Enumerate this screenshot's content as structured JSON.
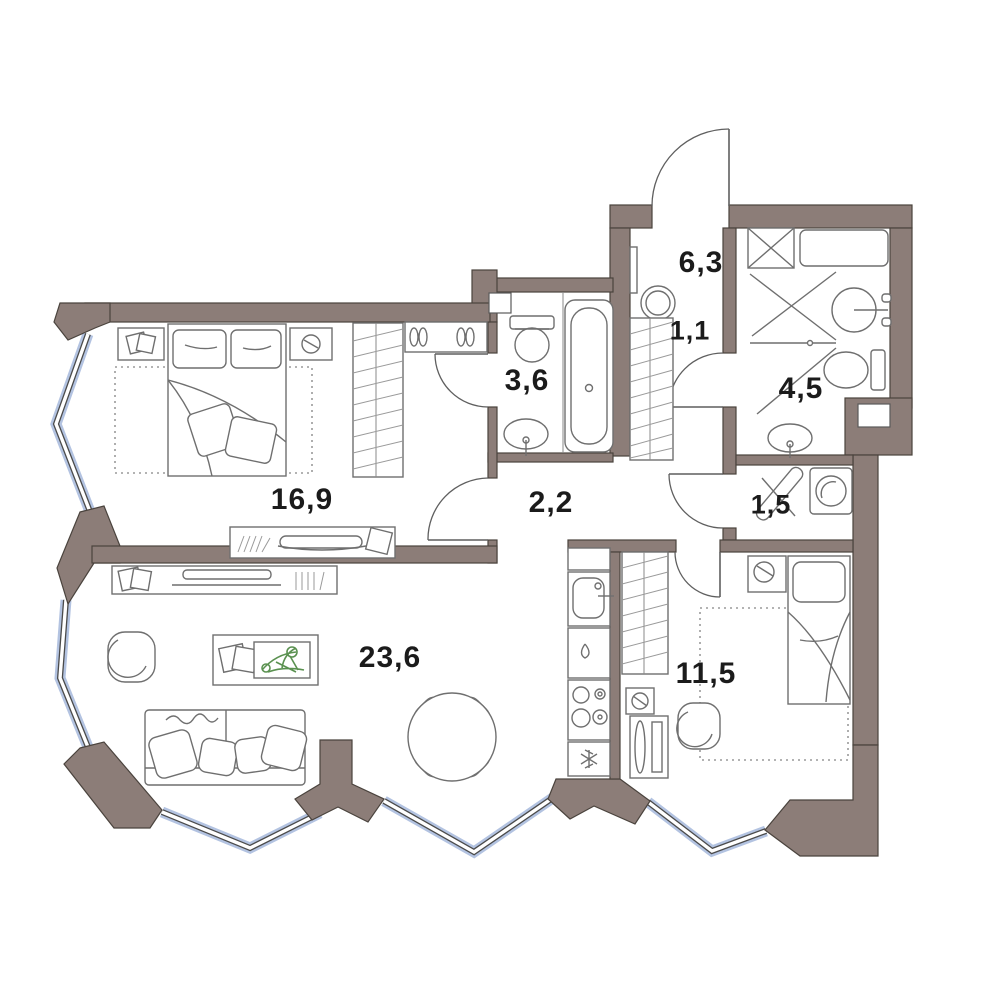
{
  "plan": {
    "rooms": [
      {
        "name": "hallway",
        "area": "6,3",
        "x": 701,
        "y": 263,
        "fs": 30
      },
      {
        "name": "hall-wardrobe",
        "area": "1,1",
        "x": 690,
        "y": 331,
        "fs": 27
      },
      {
        "name": "shower-room",
        "area": "4,5",
        "x": 801,
        "y": 389,
        "fs": 30
      },
      {
        "name": "bathroom",
        "area": "3,6",
        "x": 527,
        "y": 381,
        "fs": 30
      },
      {
        "name": "corridor",
        "area": "2,2",
        "x": 551,
        "y": 503,
        "fs": 30
      },
      {
        "name": "laundry",
        "area": "1,5",
        "x": 771,
        "y": 505,
        "fs": 27
      },
      {
        "name": "bedroom",
        "area": "16,9",
        "x": 302,
        "y": 500,
        "fs": 30
      },
      {
        "name": "living-room-kitchen",
        "area": "23,6",
        "x": 390,
        "y": 658,
        "fs": 30
      },
      {
        "name": "bedroom-2",
        "area": "11,5",
        "x": 706,
        "y": 674,
        "fs": 30
      }
    ],
    "colors": {
      "wall": "#8c7d78",
      "window_glazing": "#b3c3e1",
      "plant": "#5a9150",
      "label": "#1b1b1b",
      "background": "#ffffff"
    }
  }
}
